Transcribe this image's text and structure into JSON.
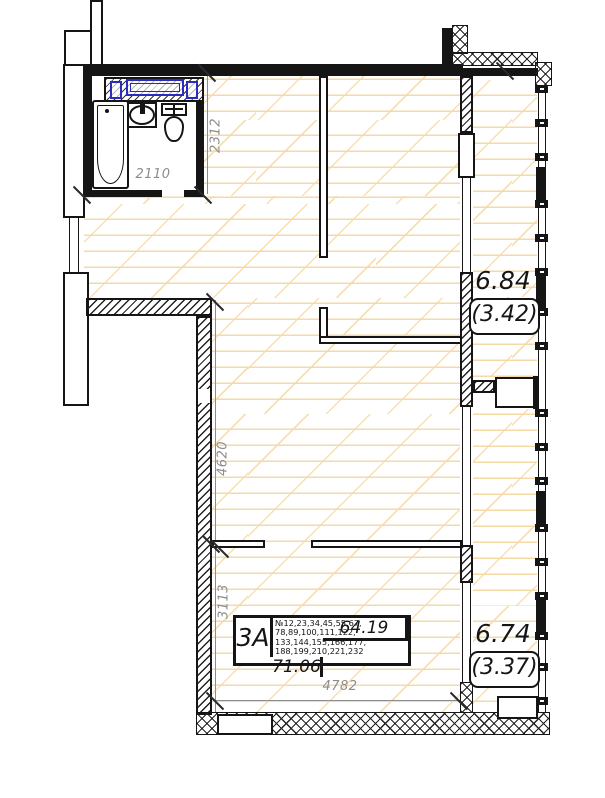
{
  "plan": {
    "dimensions": {
      "bath_height": "2312",
      "bath_width": "2110",
      "room_left_upper": "4620",
      "room_left_lower": "3113",
      "room_bottom": "4782"
    },
    "balcony_upper": {
      "area": "6.84",
      "area_reduced": "(3.42)"
    },
    "balcony_lower": {
      "area": "6.74",
      "area_reduced": "(3.37)"
    },
    "info_table": {
      "flat_type": "3А",
      "area_main": "64.19",
      "area_total": "71.06",
      "unit_numbers": [
        "№12,23,34,45,55,67,",
        "78,89,100,111,122,",
        "133,144,155,166,177,",
        "188,199,210,221,232"
      ]
    },
    "colors": {
      "wall": "#151515",
      "floor_line": "#f5d9a6",
      "plumbing_blue": "#2b2bc0",
      "dim_text": "#8d8d8d"
    }
  }
}
